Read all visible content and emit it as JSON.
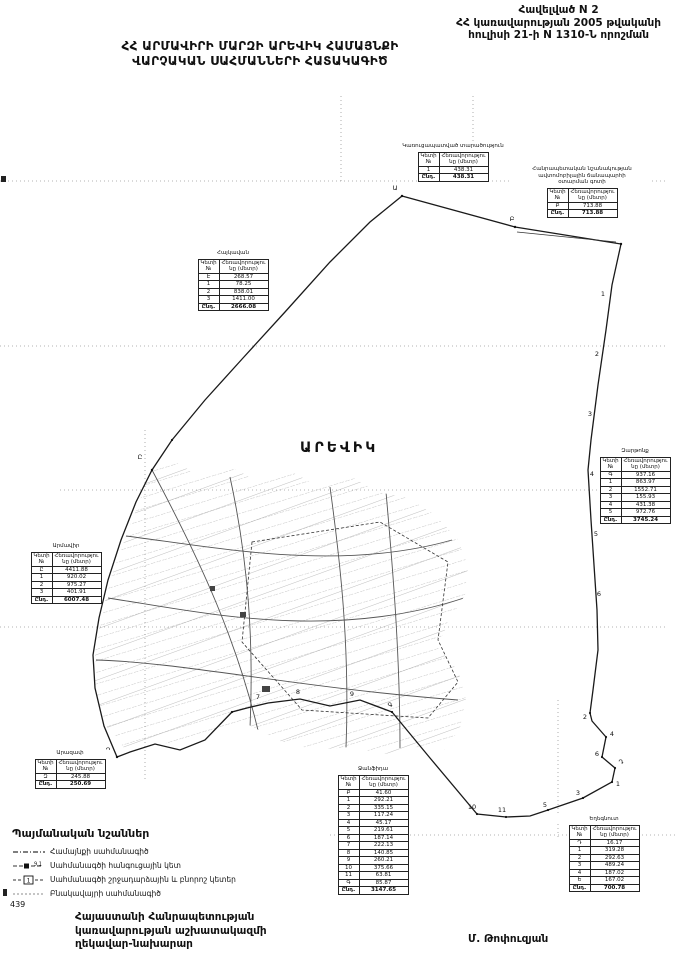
{
  "colors": {
    "ink": "#111111",
    "boundary": "#1a1a1a",
    "grid_dots": "#9a9a9a",
    "parcel_lines": "#8a8a8a"
  },
  "page": {
    "annex": [
      "Հավելված N 2",
      "ՀՀ կառավարության 2005 թվականի",
      "հուլիսի 21-ի N 1310-Ն որոշման"
    ],
    "title": [
      "ՀՀ ԱՐՄԱՎԻՐԻ ՄԱՐԶԻ ԱՐԵՎԻԿ ՀԱՄԱՅՆՔԻ",
      "ՎԱՐՉԱԿԱՆ ՍԱՀՄԱՆՆԵՐԻ ՀԱՏԱԿԱԳԻԾ"
    ],
    "page_number": "439",
    "footer_left": [
      "Հայաստանի Հանրապետության",
      "կառավարության աշխատակազմի",
      "ղեկավար-նախարար"
    ],
    "footer_right": "Մ. Թոփուզյան"
  },
  "map": {
    "community_label": "ԱՐԵՎԻԿ",
    "point_labels": [
      {
        "t": "Ա",
        "x": 395,
        "y": 190
      },
      {
        "t": "Բ",
        "x": 512,
        "y": 221
      },
      {
        "t": "1",
        "x": 603,
        "y": 296
      },
      {
        "t": "2",
        "x": 597,
        "y": 356
      },
      {
        "t": "3",
        "x": 590,
        "y": 416
      },
      {
        "t": "4",
        "x": 592,
        "y": 476
      },
      {
        "t": "5",
        "x": 596,
        "y": 536
      },
      {
        "t": "6",
        "x": 599,
        "y": 596
      },
      {
        "t": "2",
        "x": 585,
        "y": 719
      },
      {
        "t": "4",
        "x": 612,
        "y": 736
      },
      {
        "t": "6",
        "x": 597,
        "y": 756
      },
      {
        "t": "Դ",
        "x": 621,
        "y": 764
      },
      {
        "t": "1",
        "x": 618,
        "y": 786
      },
      {
        "t": "3",
        "x": 578,
        "y": 795
      },
      {
        "t": "5",
        "x": 545,
        "y": 807
      },
      {
        "t": "11",
        "x": 502,
        "y": 812
      },
      {
        "t": "10",
        "x": 472,
        "y": 809
      },
      {
        "t": "Գ",
        "x": 390,
        "y": 707
      },
      {
        "t": "9",
        "x": 352,
        "y": 696
      },
      {
        "t": "8",
        "x": 298,
        "y": 694
      },
      {
        "t": "7",
        "x": 258,
        "y": 699
      },
      {
        "t": "Զ",
        "x": 108,
        "y": 752
      },
      {
        "t": "Ը",
        "x": 140,
        "y": 459
      }
    ]
  },
  "legend": {
    "title": "Պայմանական նշաններ",
    "items": [
      {
        "symbol": "community-boundary-line",
        "label": "Համայնքի սահմանագիծ"
      },
      {
        "symbol": "junction-point",
        "label": "Սահմանագծի հանգուցային կետ"
      },
      {
        "symbol": "turning-point",
        "label": "Սահմանագծի շրջադարձային և բնորոշ կետեր"
      },
      {
        "symbol": "settlement-boundary-line",
        "label": "Բնակավայրի սահմանագիծ"
      }
    ]
  },
  "table_headers": {
    "col1": "Կետի №",
    "col2": "Հեռավորությունը (մետր)",
    "total": "Ընդ."
  },
  "tables": [
    {
      "id": "top-left",
      "title": [
        "Հայկավան"
      ],
      "rows": [
        [
          "Է",
          "268.57"
        ],
        [
          "1",
          "78.25"
        ],
        [
          "2",
          "838.01"
        ],
        [
          "3",
          "1411.00"
        ]
      ],
      "total": "2666.08"
    },
    {
      "id": "top-middle",
      "title": [
        "Կառուցապատված տարածություն"
      ],
      "rows": [
        [
          "1",
          "438.31"
        ]
      ],
      "total": "438.31"
    },
    {
      "id": "top-right",
      "title": [
        "Հանրապետական նշանակության",
        "ավտոմոբիլային ճանապարհի",
        "օտարման գոտի"
      ],
      "rows": [
        [
          "Բ",
          "713.88"
        ]
      ],
      "total": "713.88"
    },
    {
      "id": "right",
      "title": [
        "Զարթոնք"
      ],
      "rows": [
        [
          "Գ",
          "937.16"
        ],
        [
          "1",
          "863.97"
        ],
        [
          "2",
          "1552.71"
        ],
        [
          "3",
          "155.93"
        ],
        [
          "4",
          "431.38"
        ],
        [
          "5",
          "972.76"
        ]
      ],
      "total": "3745.24"
    },
    {
      "id": "left",
      "title": [
        "Արմավիր"
      ],
      "rows": [
        [
          "Ը",
          "4411.88"
        ],
        [
          "1",
          "920.02"
        ],
        [
          "2",
          "975.27"
        ],
        [
          "3",
          "401.91"
        ]
      ],
      "total": "6007.48"
    },
    {
      "id": "bottom-left",
      "title": [
        "Արազափ"
      ],
      "rows": [
        [
          "Զ",
          "245.88"
        ]
      ],
      "total": "250.69"
    },
    {
      "id": "bottom-middle",
      "title": [
        "Ջանֆիդա"
      ],
      "rows": [
        [
          "Բ",
          "41.60"
        ],
        [
          "1",
          "292.21"
        ],
        [
          "2",
          "335.15"
        ],
        [
          "3",
          "117.24"
        ],
        [
          "4",
          "45.17"
        ],
        [
          "5",
          "219.61"
        ],
        [
          "6",
          "187.14"
        ],
        [
          "7",
          "222.13"
        ],
        [
          "8",
          "140.85"
        ],
        [
          "9",
          "260.21"
        ],
        [
          "10",
          "375.66"
        ],
        [
          "11",
          "63.81"
        ],
        [
          "Գ",
          "85.87"
        ]
      ],
      "total": "3147.65"
    },
    {
      "id": "bottom-right",
      "title": [
        "Եղեգնուտ"
      ],
      "rows": [
        [
          "Դ",
          "16.17"
        ],
        [
          "1",
          "319.28"
        ],
        [
          "2",
          "292.63"
        ],
        [
          "3",
          "489.24"
        ],
        [
          "4",
          "187.02"
        ],
        [
          "Ե",
          "167.02"
        ]
      ],
      "total": "700.78"
    }
  ]
}
